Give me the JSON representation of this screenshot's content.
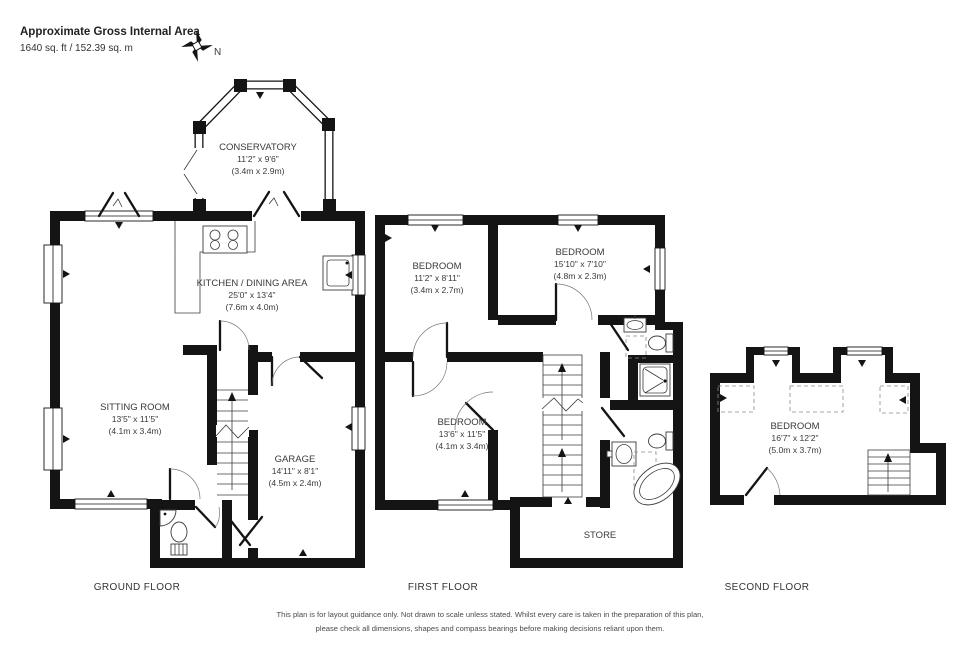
{
  "header": {
    "title": "Approximate Gross Internal Area",
    "area": "1640 sq. ft / 152.39 sq. m"
  },
  "compass": {
    "north_label": "N"
  },
  "floors": [
    {
      "label": "GROUND FLOOR"
    },
    {
      "label": "FIRST FLOOR"
    },
    {
      "label": "SECOND FLOOR"
    }
  ],
  "rooms": {
    "conservatory": {
      "name": "CONSERVATORY",
      "dims_ft": "11'2\" x 9'6\"",
      "dims_m": "(3.4m x 2.9m)"
    },
    "kitchen_dining": {
      "name": "KITCHEN / DINING AREA",
      "dims_ft": "25'0\" x 13'4\"",
      "dims_m": "(7.6m x 4.0m)"
    },
    "sitting_room": {
      "name": "SITTING ROOM",
      "dims_ft": "13'5\" x 11'5\"",
      "dims_m": "(4.1m x 3.4m)"
    },
    "garage": {
      "name": "GARAGE",
      "dims_ft": "14'11\" x 8'1\"",
      "dims_m": "(4.5m x 2.4m)"
    },
    "bedroom_1": {
      "name": "BEDROOM",
      "dims_ft": "11'2\" x 8'11\"",
      "dims_m": "(3.4m x 2.7m)"
    },
    "bedroom_2": {
      "name": "BEDROOM",
      "dims_ft": "15'10\" x 7'10\"",
      "dims_m": "(4.8m x 2.3m)"
    },
    "bedroom_3": {
      "name": "BEDROOM",
      "dims_ft": "13'6\" x 11'5\"",
      "dims_m": "(4.1m x 3.4m)"
    },
    "store": {
      "name": "STORE"
    },
    "bedroom_4": {
      "name": "BEDROOM",
      "dims_ft": "16'7\" x 12'2\"",
      "dims_m": "(5.0m x 3.7m)"
    }
  },
  "disclaimer": {
    "line1": "This plan is for layout guidance only.  Not drawn to scale unless stated. Whilst every care is taken in the preparation of this plan,",
    "line2": "please check all dimensions, shapes and compass bearings before making decisions reliant upon them."
  },
  "colors": {
    "wall": "#141414",
    "text": "#3a3a3a"
  }
}
